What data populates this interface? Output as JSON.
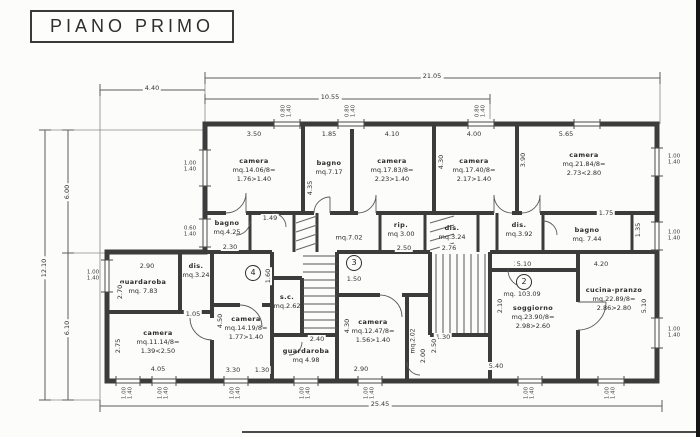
{
  "title": "PIANO PRIMO",
  "colors": {
    "ink": "#3c3c3c",
    "paper": "#fcfcfa"
  },
  "overall": {
    "top_total": "21.05",
    "top_mid": "10.55",
    "top_left": "4.40",
    "left_total": "12.10",
    "left_upper": "6.00",
    "left_lower": "6.10",
    "bottom_total": "25.45"
  },
  "rooms": [
    {
      "name": "camera",
      "area": "mq.14.06/8=",
      "ratio": "1.76>1.40",
      "w": "3.50"
    },
    {
      "name": "bagno",
      "area": "mq.7.17",
      "w": "1.85",
      "h": "4.35"
    },
    {
      "name": "camera",
      "area": "mq.17.83/8=",
      "ratio": "2.23>1.40",
      "w": "4.10"
    },
    {
      "name": "camera",
      "area": "mq.17.40/8=",
      "ratio": "2.17>1.40",
      "w": "4.00",
      "h": "4.30"
    },
    {
      "name": "camera",
      "area": "mq.21.84/8=",
      "ratio": "2.73<2.80",
      "w": "5.65",
      "h": "3.90"
    },
    {
      "name": "bagno",
      "area": "mq.4.25",
      "w": "2.30"
    },
    {
      "name": "",
      "area": "mq.7.02"
    },
    {
      "name": "rip.",
      "area": "mq 3.00",
      "w": "2.50"
    },
    {
      "name": "dis.",
      "area": "mq.3.24",
      "w": "2.76"
    },
    {
      "name": "dis.",
      "area": "mq.3.92",
      "w": "2.10"
    },
    {
      "name": "bagno",
      "area": "mq. 7.44",
      "w": "1.75",
      "h": "1.35"
    },
    {
      "name": "guardaroba",
      "area": "mq. 7.83",
      "w": "2.90",
      "h": "2.70"
    },
    {
      "name": "dis.",
      "area": "mq.3.24",
      "w": "1.05"
    },
    {
      "name": "camera",
      "area": "mq.11.14/8=",
      "ratio": "1.39<2.50",
      "w": "4.05",
      "h": "2.75"
    },
    {
      "name": "camera",
      "area": "mq.14.19/8=",
      "ratio": "1.77>1.40",
      "w": "3.30",
      "h": "4.50"
    },
    {
      "name": "s.c.",
      "area": "mq.2.62"
    },
    {
      "name": "guardaroba",
      "area": "mq 4.98",
      "w": "2.40"
    },
    {
      "name": "camera",
      "area": "mq.12.47/8=",
      "ratio": "1.56>1.40",
      "w": "2.90",
      "h": "4.30"
    },
    {
      "name": "",
      "area": "mq.2.02",
      "h": "2.00"
    },
    {
      "name": "soggiorno",
      "area": "mq.23.90/8=",
      "ratio": "2.98>2.60",
      "w": "5.10",
      "w2": "5.40",
      "h": "2.10"
    },
    {
      "name": "cucina-pranzo",
      "area": "mq.22.89/8=",
      "ratio": "2.86>2.80",
      "w": "4.20",
      "h": "5.10"
    }
  ],
  "apartments": [
    {
      "number": "4"
    },
    {
      "number": "3",
      "dim_below": "1.50"
    },
    {
      "number": "2",
      "total_area": "mq. 103.09"
    }
  ],
  "windows": {
    "std": [
      "1.00",
      "1.40"
    ],
    "small": [
      "0.60",
      "1.40"
    ],
    "top": [
      "0.80",
      "1.40"
    ]
  },
  "misc_dims": {
    "stair_door": "1.49",
    "near_apt4": "1.60",
    "door_a": "1.30",
    "door_b": "1.30",
    "stair_width": "2.50"
  }
}
